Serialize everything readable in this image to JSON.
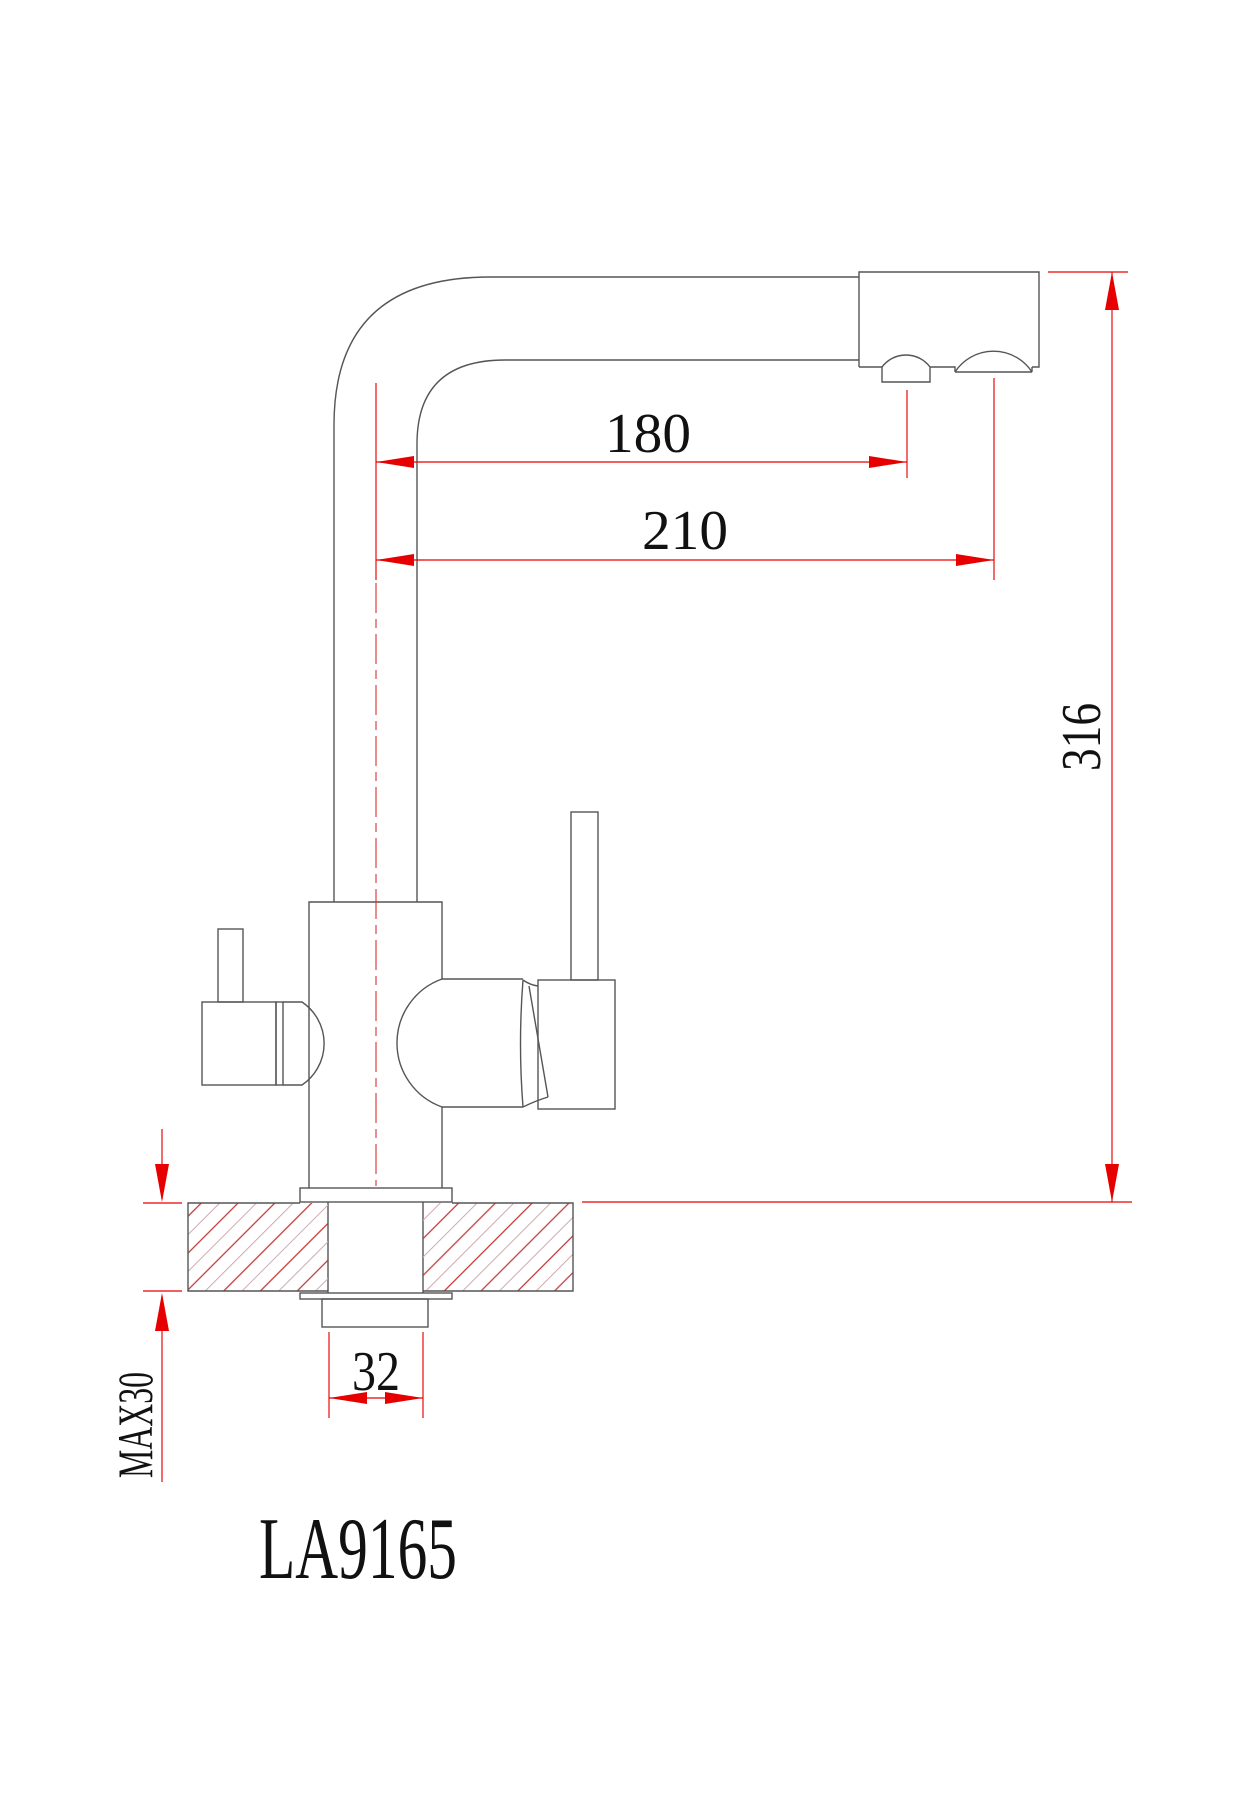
{
  "drawing": {
    "model_label": "LA9165",
    "dim_spout_reach": "180",
    "dim_outlet_reach": "210",
    "dim_total_height": "316",
    "dim_shank_width": "32",
    "dim_max_counter_thickness": "MAX30"
  },
  "colors": {
    "background": "#ffffff",
    "outline_gray": "#555555",
    "dimension_red": "#e60000",
    "centerline_red": "#d83030",
    "hatch_red": "#c03535",
    "hatch_light": "#ccaab2",
    "text": "#111111"
  }
}
